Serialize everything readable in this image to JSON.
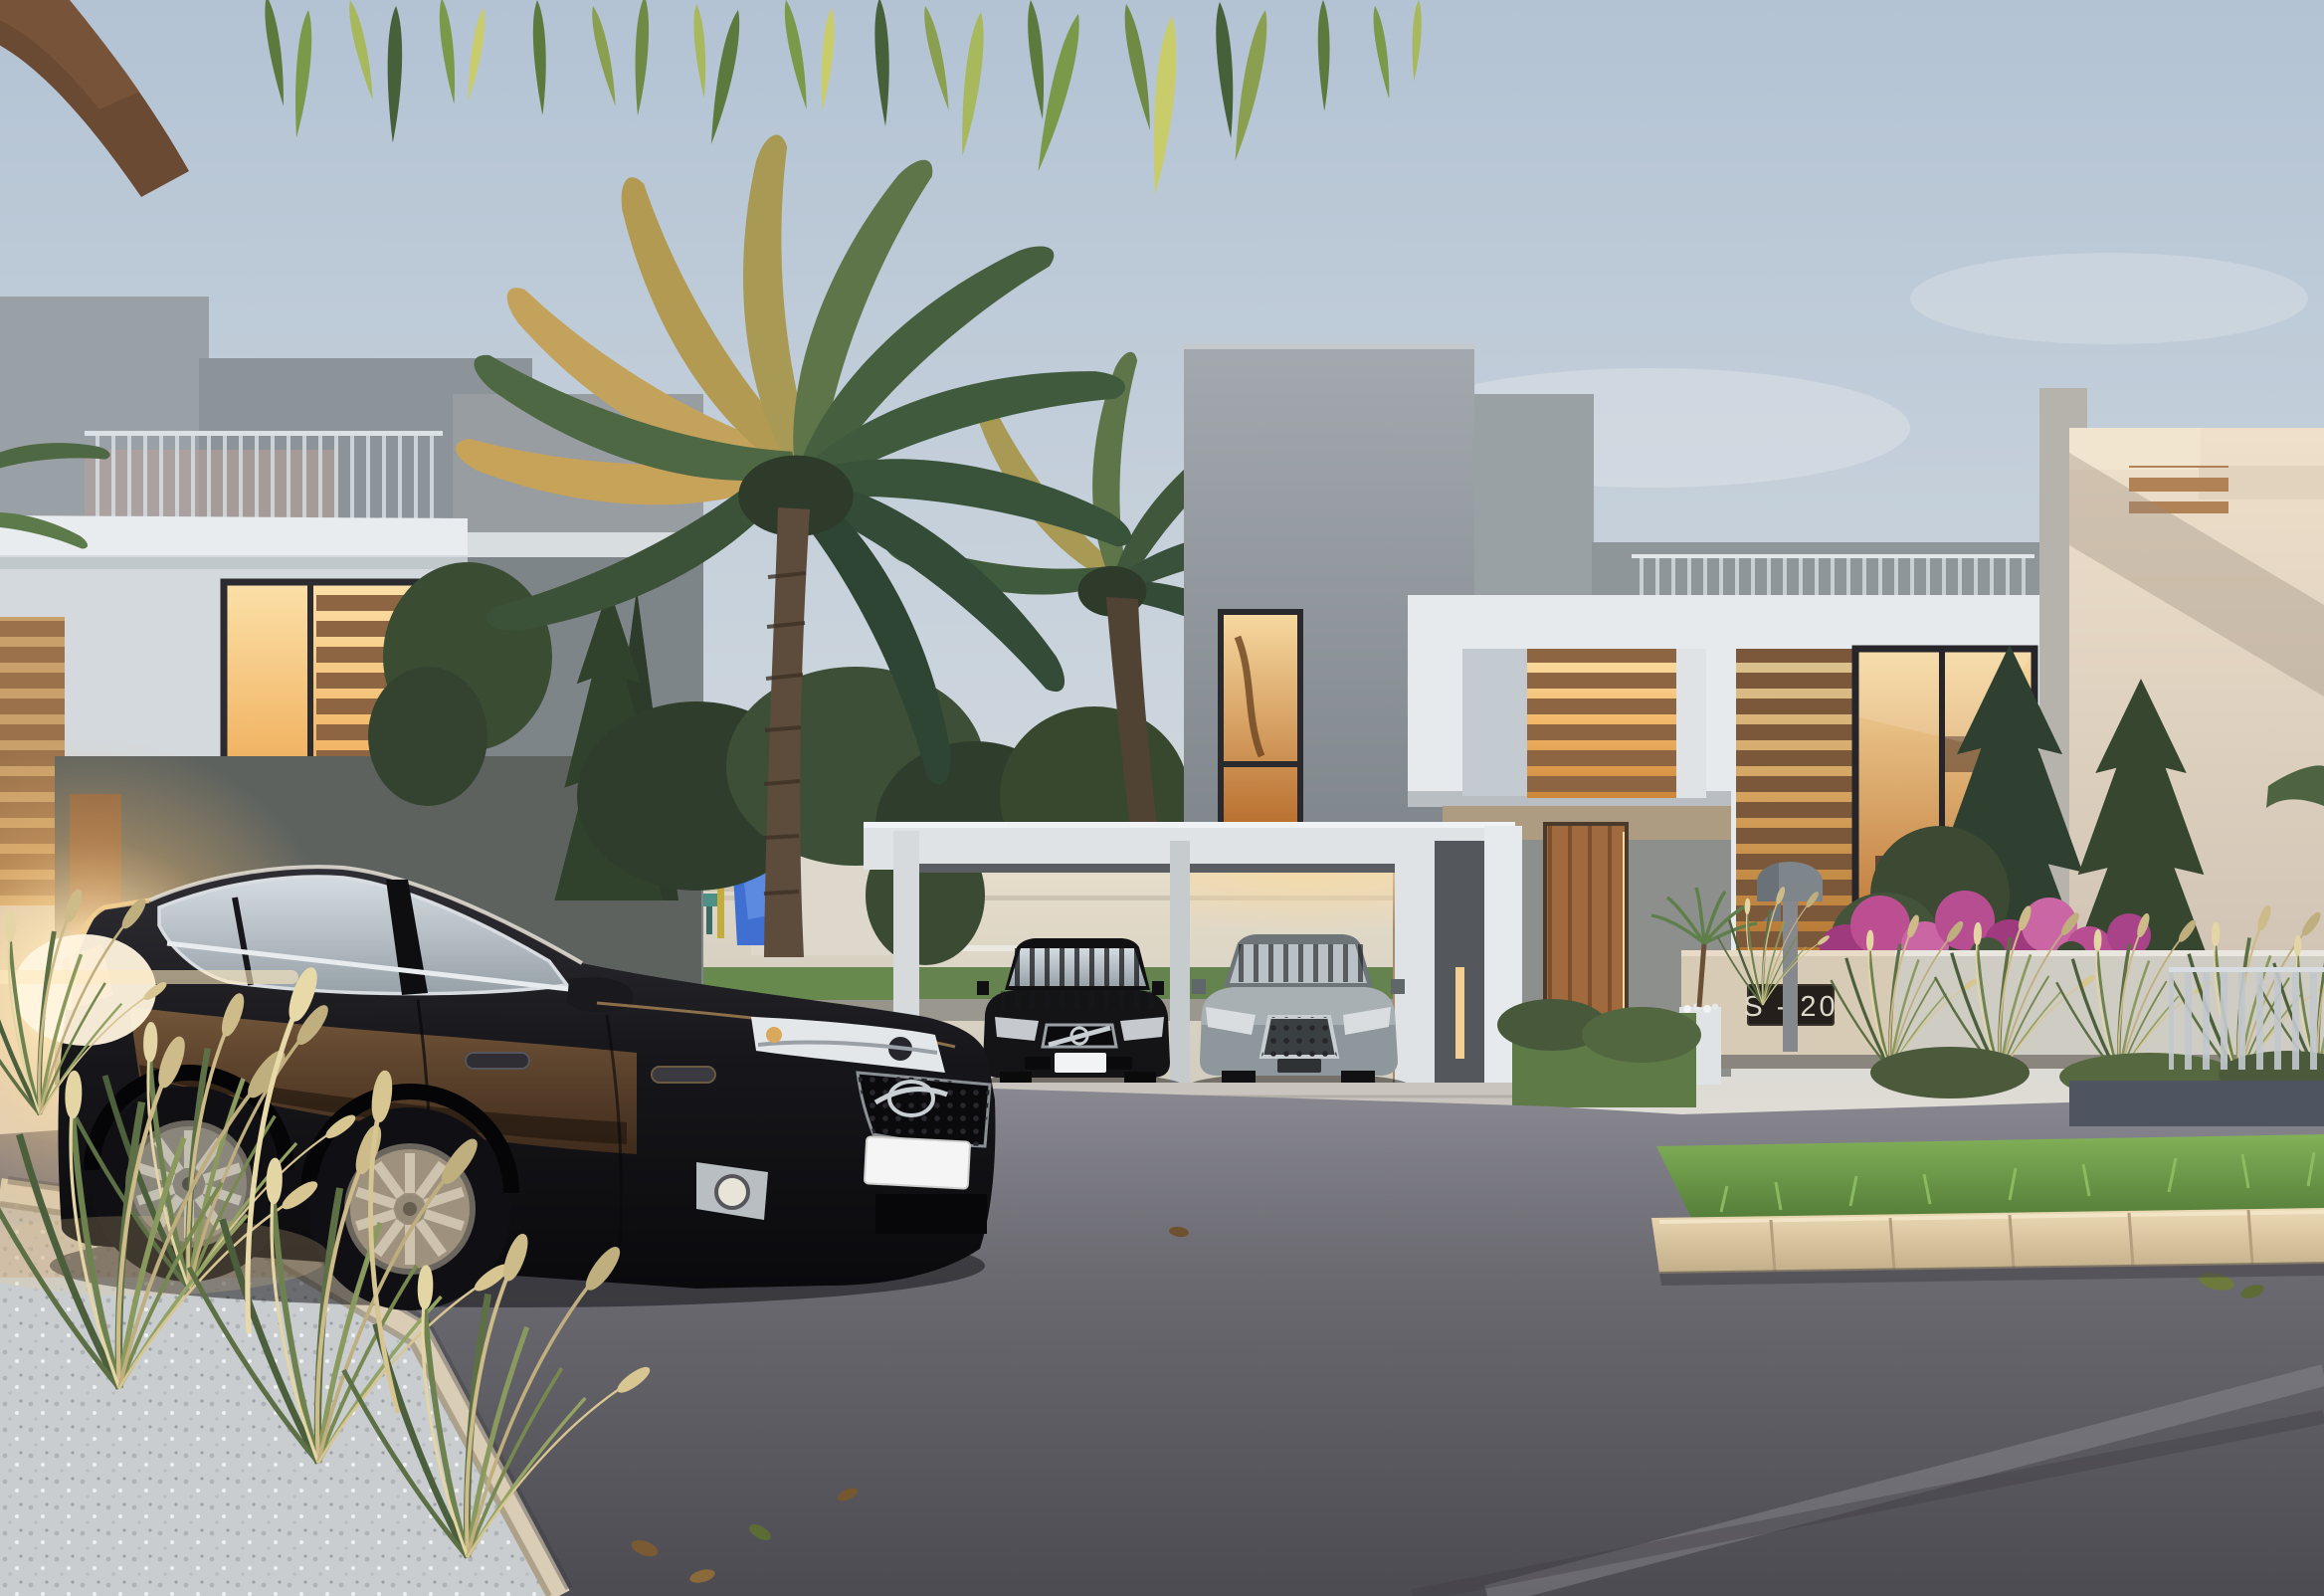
{
  "scene": {
    "type": "architectural-dusk-render",
    "description": "Photoreal dusk rendering of a modern villa community: two-storey flat-roof villas with wooden louvers and warm-lit windows, a white carport sheltering two parked cars, a dark sedan on the foreground street, palm trees, ornamental grasses and pink bougainvillea",
    "sign": {
      "label": "S - 20",
      "background": "#241f1a",
      "text_color": "#ddd8cc"
    },
    "foreground_car": {
      "color_name": "black sedan",
      "front_plate_text": ""
    },
    "carport_cars": [
      {
        "color_name": "black compact",
        "plate_text": ""
      },
      {
        "color_name": "grey sedan",
        "plate_text": ""
      }
    ],
    "palette": {
      "sky_top": "#b3c3d4",
      "sky_mid": "#ccd5dd",
      "sky_horizon": "#ece5d6",
      "villa_white": "#e6eaed",
      "villa_gray": "#8d9499",
      "villa_gray_dark": "#70777b",
      "cream_wall": "#ecdcc6",
      "wood_louver": "#9c7350",
      "warm_window": "#f2b768",
      "warm_window_deep": "#c9832f",
      "asphalt": "#5f5e64",
      "curb_stone": "#e3cfae",
      "lawn_green": "#6f9a4e",
      "foliage_dark": "#33432f",
      "palm_gold": "#c3a35c",
      "bougainvillea_pink": "#bb4f92",
      "car_black": "#141418",
      "car_grey": "#8e979b",
      "sun_flare": "#ffe9c0",
      "gravel": "#cdd1d4"
    }
  }
}
